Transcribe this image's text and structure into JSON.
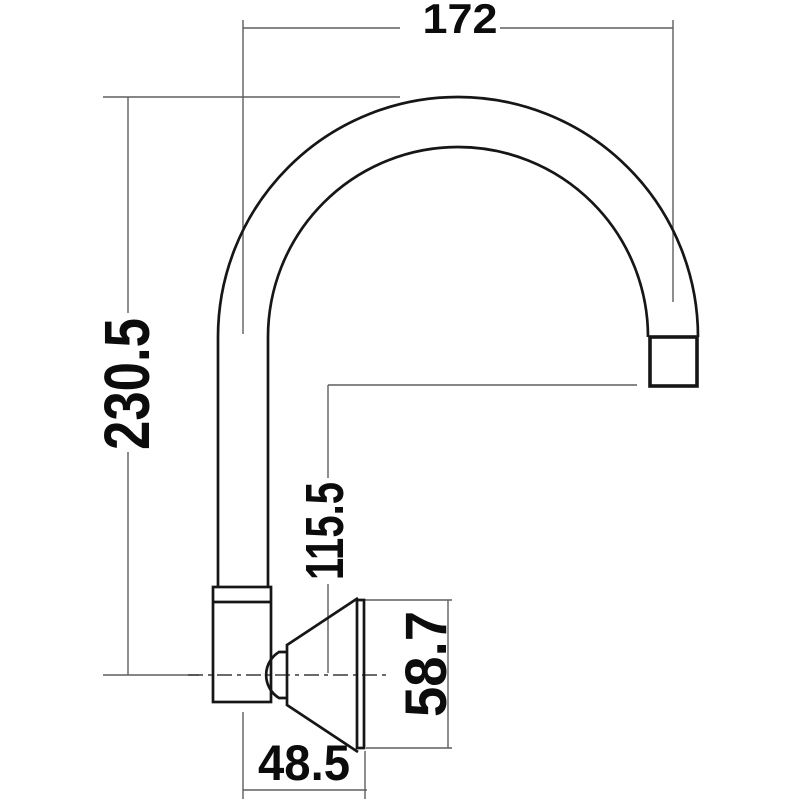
{
  "drawing": {
    "labels": {
      "overall_width": "172",
      "overall_height": "230.5",
      "spout_height": "115.5",
      "flange_height": "58.7",
      "wall_offset": "48.5"
    },
    "colors": {
      "background": "#ffffff",
      "object_line": "#161616",
      "dimension_line": "#5e5e5e",
      "centerline": "#3a3a3a",
      "label_text": "#0c0c0c"
    }
  }
}
